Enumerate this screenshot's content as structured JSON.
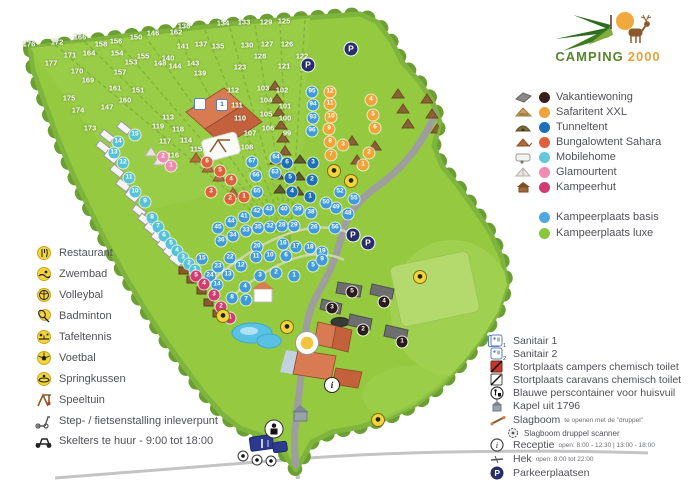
{
  "logo": {
    "word1": "CAMPING",
    "word2": "2000"
  },
  "legend_left": {
    "items": [
      {
        "label": "Restaurant"
      },
      {
        "label": "Zwembad"
      },
      {
        "label": "Volleybal"
      },
      {
        "label": "Badminton"
      },
      {
        "label": "Tafeltennis"
      },
      {
        "label": "Voetbal"
      },
      {
        "label": "Springkussen"
      },
      {
        "label": "Speeltuin"
      },
      {
        "label": "Step- / fietsenstalling inleverpunt"
      },
      {
        "label": "Skelters te huur - 9:00 tot 18:00"
      }
    ]
  },
  "legend_accommodation": {
    "items": [
      {
        "label": "Vakantiewoning",
        "color": "#3A1E1E"
      },
      {
        "label": "Safaritent XXL",
        "color": "#F0A23C"
      },
      {
        "label": "Tunneltent",
        "color": "#1C6FB8"
      },
      {
        "label": "Bungalowtent Sahara",
        "color": "#E0603C"
      },
      {
        "label": "Mobilehome",
        "color": "#64C8DC"
      },
      {
        "label": "Glamourtent",
        "color": "#F08CB4"
      },
      {
        "label": "Kampeerhut",
        "color": "#D23A72"
      }
    ],
    "pitches": [
      {
        "label": "Kampeerplaats basis",
        "color": "#4FA8E0"
      },
      {
        "label": "Kampeerplaats luxe",
        "color": "#8CC63E"
      }
    ]
  },
  "legend_services": {
    "items": [
      {
        "label": "Sanitair 1"
      },
      {
        "label": "Sanitair 2"
      },
      {
        "label": "Stortplaats campers chemisch toilet"
      },
      {
        "label": "Stortplaats caravans chemisch toilet"
      },
      {
        "label": "Blauwe perscontainer voor huisvuil"
      },
      {
        "label": "Kapel uit 1796"
      },
      {
        "label": "Slagboom",
        "detail": "te openen met de \"druppel\""
      },
      {
        "label": "Slagboom druppel scanner",
        "sub": true
      },
      {
        "label": "Receptie",
        "detail": "open: 8:00 - 12:30  |  13:00 - 18:00"
      },
      {
        "label": "Hek",
        "detail": "open: 8:00 tot 22:00"
      },
      {
        "label": "Parkeerplaatsen"
      }
    ]
  },
  "map": {
    "grass_color": "#95C93F",
    "tree_color": "#6B9E33",
    "road_color": "#9E9E9E",
    "marker_groups": [
      {
        "name": "plot-number",
        "cls": "plot",
        "items": [
          [
            176,
            29,
            44
          ],
          [
            172,
            57,
            42
          ],
          [
            166,
            80,
            37
          ],
          [
            158,
            101,
            44
          ],
          [
            156,
            116,
            41
          ],
          [
            150,
            136,
            37
          ],
          [
            146,
            153,
            33
          ],
          [
            162,
            176,
            32
          ],
          [
            136,
            184,
            26
          ],
          [
            134,
            223,
            23
          ],
          [
            133,
            244,
            22
          ],
          [
            129,
            266,
            22
          ],
          [
            125,
            284,
            21
          ],
          [
            171,
            70,
            55
          ],
          [
            164,
            89,
            53
          ],
          [
            154,
            117,
            53
          ],
          [
            155,
            143,
            56
          ],
          [
            148,
            160,
            63
          ],
          [
            141,
            183,
            46
          ],
          [
            137,
            201,
            44
          ],
          [
            135,
            218,
            46
          ],
          [
            130,
            247,
            45
          ],
          [
            127,
            267,
            44
          ],
          [
            126,
            287,
            44
          ],
          [
            177,
            51,
            63
          ],
          [
            170,
            77,
            71
          ],
          [
            169,
            88,
            80
          ],
          [
            161,
            115,
            88
          ],
          [
            160,
            125,
            100
          ],
          [
            157,
            120,
            72
          ],
          [
            153,
            131,
            62
          ],
          [
            151,
            138,
            90
          ],
          [
            147,
            107,
            107
          ],
          [
            175,
            69,
            98
          ],
          [
            174,
            78,
            110
          ],
          [
            173,
            90,
            128
          ],
          [
            144,
            175,
            66
          ],
          [
            140,
            168,
            58
          ],
          [
            143,
            193,
            63
          ],
          [
            139,
            200,
            73
          ],
          [
            123,
            240,
            67
          ],
          [
            121,
            284,
            66
          ],
          [
            128,
            260,
            56
          ],
          [
            122,
            302,
            56
          ],
          [
            124,
            306,
            68
          ],
          [
            113,
            168,
            117
          ],
          [
            117,
            165,
            141
          ],
          [
            116,
            173,
            155
          ],
          [
            114,
            186,
            140
          ],
          [
            115,
            196,
            149
          ],
          [
            118,
            178,
            129
          ],
          [
            119,
            158,
            126
          ],
          [
            112,
            233,
            90
          ],
          [
            111,
            237,
            105
          ],
          [
            110,
            240,
            118
          ],
          [
            103,
            263,
            88
          ],
          [
            102,
            282,
            90
          ],
          [
            104,
            266,
            100
          ],
          [
            101,
            285,
            106
          ],
          [
            105,
            266,
            114
          ],
          [
            100,
            285,
            118
          ],
          [
            106,
            268,
            128
          ],
          [
            99,
            287,
            133
          ],
          [
            107,
            250,
            133
          ],
          [
            108,
            247,
            147
          ]
        ]
      },
      {
        "name": "kampeerplaats-basis-marker",
        "cls": "dot",
        "color": "#3F9BDB",
        "items": [
          [
            95,
            312,
            92
          ],
          [
            94,
            313,
            105
          ],
          [
            93,
            313,
            118
          ],
          [
            96,
            312,
            131
          ],
          [
            67,
            252,
            162
          ],
          [
            64,
            276,
            158
          ],
          [
            66,
            256,
            176
          ],
          [
            63,
            275,
            173
          ],
          [
            65,
            257,
            192
          ],
          [
            52,
            340,
            192
          ],
          [
            55,
            354,
            199
          ],
          [
            49,
            336,
            208
          ],
          [
            48,
            348,
            214
          ],
          [
            50,
            326,
            203
          ],
          [
            56,
            335,
            228
          ],
          [
            45,
            218,
            228
          ],
          [
            44,
            231,
            222
          ],
          [
            41,
            244,
            217
          ],
          [
            42,
            257,
            212
          ],
          [
            43,
            269,
            210
          ],
          [
            40,
            284,
            210
          ],
          [
            39,
            298,
            210
          ],
          [
            38,
            311,
            213
          ],
          [
            36,
            221,
            241
          ],
          [
            34,
            233,
            236
          ],
          [
            33,
            246,
            231
          ],
          [
            35,
            258,
            228
          ],
          [
            32,
            270,
            227
          ],
          [
            28,
            282,
            226
          ],
          [
            29,
            294,
            226
          ],
          [
            26,
            314,
            228
          ],
          [
            15,
            202,
            259
          ],
          [
            22,
            230,
            258
          ],
          [
            20,
            257,
            247
          ],
          [
            16,
            283,
            244
          ],
          [
            17,
            296,
            247
          ],
          [
            18,
            310,
            248
          ],
          [
            19,
            322,
            252
          ],
          [
            23,
            218,
            267
          ],
          [
            24,
            210,
            276
          ],
          [
            13,
            228,
            275
          ],
          [
            12,
            241,
            266
          ],
          [
            14,
            217,
            285
          ],
          [
            11,
            256,
            257
          ],
          [
            10,
            270,
            256
          ],
          [
            6,
            286,
            256
          ],
          [
            5,
            313,
            266
          ],
          [
            9,
            322,
            260
          ],
          [
            1,
            294,
            276
          ],
          [
            2,
            276,
            273
          ],
          [
            3,
            260,
            276
          ],
          [
            4,
            245,
            287
          ],
          [
            7,
            246,
            300
          ],
          [
            8,
            232,
            298
          ]
        ]
      },
      {
        "name": "mobilehome-marker",
        "cls": "dot",
        "color": "#56C2D9",
        "items": [
          [
            15,
            135,
            135
          ],
          [
            14,
            118,
            142
          ],
          [
            13,
            114,
            153
          ],
          [
            12,
            123,
            163
          ],
          [
            11,
            129,
            178
          ],
          [
            10,
            135,
            192
          ],
          [
            9,
            145,
            202
          ],
          [
            8,
            152,
            218
          ],
          [
            7,
            158,
            227
          ],
          [
            6,
            164,
            236
          ],
          [
            5,
            171,
            244
          ],
          [
            4,
            177,
            251
          ],
          [
            3,
            183,
            258
          ],
          [
            2,
            189,
            264
          ],
          [
            1,
            195,
            270
          ]
        ]
      },
      {
        "name": "kampeerhut-marker",
        "cls": "dot",
        "color": "#D23A72",
        "items": [
          [
            5,
            196,
            276
          ],
          [
            4,
            204,
            284
          ],
          [
            3,
            214,
            295
          ],
          [
            2,
            221,
            307
          ],
          [
            1,
            230,
            318
          ]
        ]
      },
      {
        "name": "glamourtent-marker",
        "cls": "dot",
        "color": "#F08CB4",
        "items": [
          [
            2,
            163,
            157
          ],
          [
            1,
            171,
            166
          ]
        ]
      },
      {
        "name": "bungalowtent-sahara-marker",
        "cls": "dot",
        "color": "#E06039",
        "items": [
          [
            6,
            207,
            162
          ],
          [
            5,
            220,
            171
          ],
          [
            4,
            231,
            180
          ],
          [
            3,
            211,
            192
          ],
          [
            2,
            230,
            199
          ],
          [
            1,
            244,
            197
          ]
        ]
      },
      {
        "name": "safaritent-marker",
        "cls": "dot",
        "color": "#F2A237",
        "items": [
          [
            12,
            330,
            92
          ],
          [
            11,
            330,
            104
          ],
          [
            10,
            331,
            117
          ],
          [
            9,
            329,
            129
          ],
          [
            8,
            330,
            142
          ],
          [
            7,
            331,
            155
          ],
          [
            6,
            375,
            128
          ],
          [
            5,
            373,
            115
          ],
          [
            4,
            371,
            100
          ],
          [
            3,
            343,
            145
          ],
          [
            2,
            369,
            153
          ],
          [
            1,
            363,
            165
          ]
        ]
      },
      {
        "name": "tunneltent-marker",
        "cls": "dot",
        "color": "#1C6FB8",
        "items": [
          [
            6,
            287,
            163
          ],
          [
            5,
            290,
            178
          ],
          [
            4,
            292,
            192
          ],
          [
            3,
            313,
            163
          ],
          [
            2,
            312,
            180
          ],
          [
            1,
            310,
            197
          ]
        ]
      },
      {
        "name": "vakantiewoning-marker",
        "cls": "dot dark",
        "color": "#2B1B1B",
        "items": [
          [
            5,
            352,
            292
          ],
          [
            4,
            384,
            302
          ],
          [
            3,
            332,
            308
          ],
          [
            2,
            363,
            330
          ],
          [
            1,
            402,
            342
          ]
        ]
      },
      {
        "name": "parking-icon",
        "cls": "pmark",
        "items": [
          [
            "P",
            351,
            49
          ],
          [
            "P",
            308,
            65
          ],
          [
            "P",
            353,
            235
          ],
          [
            "P",
            368,
            243
          ]
        ]
      },
      {
        "name": "facility-icon",
        "cls": "fac",
        "show": false,
        "items": [
          [
            "badminton",
            334,
            171
          ],
          [
            "volleybal",
            351,
            181
          ],
          [
            "voetbal",
            420,
            277
          ],
          [
            "zwembad",
            287,
            327
          ],
          [
            "springkussen",
            223,
            316
          ],
          [
            "skelters",
            378,
            420
          ]
        ]
      },
      {
        "name": "restaurant-icon",
        "cls": "fac-big",
        "show": false,
        "items": [
          [
            "restaurant",
            307,
            343
          ]
        ]
      },
      {
        "name": "receptie-info-icon",
        "cls": "info",
        "items": [
          [
            "i",
            332,
            385
          ]
        ]
      },
      {
        "name": "perscontainer-icon",
        "cls": "cont",
        "show": false,
        "items": [
          [
            "",
            274,
            429
          ]
        ]
      },
      {
        "name": "sanitair-icon",
        "cls": "san",
        "items": [
          [
            "1",
            222,
            105
          ],
          [
            "",
            200,
            104
          ],
          [
            "2",
            494,
            341
          ]
        ]
      },
      {
        "name": "entrance-icon",
        "cls": "ent",
        "show": false,
        "items": [
          [
            "",
            243,
            456
          ],
          [
            "",
            257,
            460
          ],
          [
            "",
            271,
            461
          ]
        ]
      }
    ]
  }
}
